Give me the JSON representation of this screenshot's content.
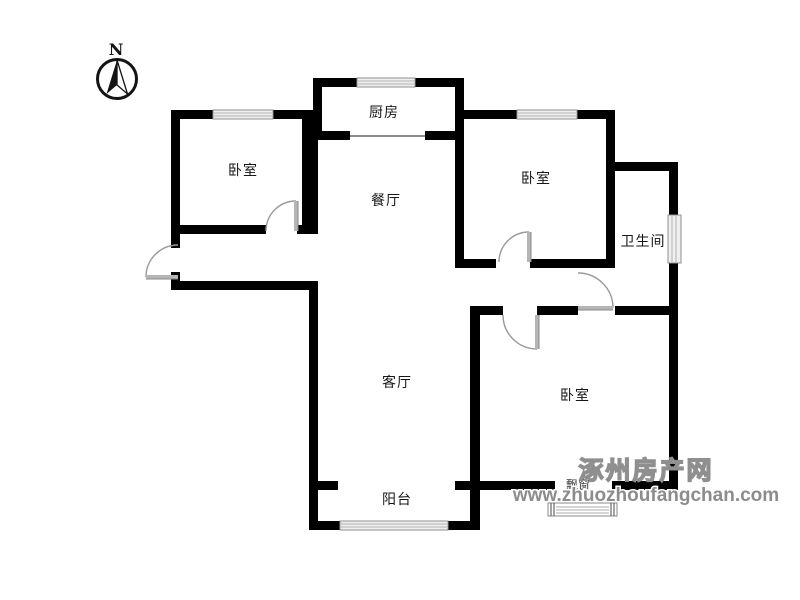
{
  "compass": {
    "label": "N"
  },
  "rooms": {
    "kitchen": {
      "label": "厨房"
    },
    "bedroom_top_left": {
      "label": "卧室"
    },
    "dining": {
      "label": "餐厅"
    },
    "bedroom_top_right": {
      "label": "卧室"
    },
    "bathroom": {
      "label": "卫生间"
    },
    "living": {
      "label": "客厅"
    },
    "bedroom_bottom": {
      "label": "卧室"
    },
    "balcony": {
      "label": "阳台"
    },
    "bay_window": {
      "label": "飘窗"
    }
  },
  "watermark": {
    "site_name": "涿州房产网",
    "site_url": "www.zhuozhoufangchan.com",
    "color": "#8c8c8c"
  },
  "colors": {
    "wall": "#000000",
    "door": "#9a9a9a",
    "window_frame": "#8f8f8f",
    "label": "#161616",
    "background": "#ffffff"
  }
}
